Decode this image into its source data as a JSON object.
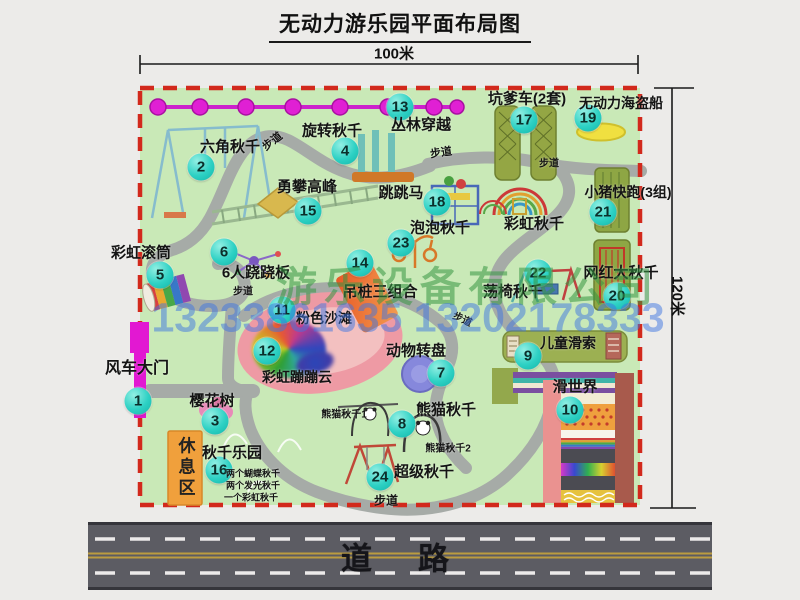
{
  "title": "无动力游乐园平面布局图",
  "dimensions": {
    "width_label": "100米",
    "height_label": "120米"
  },
  "road": {
    "label": "道路"
  },
  "rest_area": {
    "label": "休息区"
  },
  "watermark": {
    "company": "游乐设备有限公司",
    "phone": "13233861635 13202178333"
  },
  "path_label_text": "步道",
  "path_label_positions": [
    {
      "x": 272,
      "y": 141,
      "rot": -38,
      "fs": 11
    },
    {
      "x": 441,
      "y": 152,
      "rot": -8,
      "fs": 11
    },
    {
      "x": 549,
      "y": 162,
      "rot": 0,
      "fs": 10
    },
    {
      "x": 243,
      "y": 290,
      "rot": 0,
      "fs": 10
    },
    {
      "x": 463,
      "y": 318,
      "rot": 25,
      "fs": 10
    },
    {
      "x": 386,
      "y": 500,
      "rot": 0,
      "fs": 12
    }
  ],
  "extra_labels": [
    {
      "text": "彩虹秋千",
      "x": 534,
      "y": 223,
      "fs": 15
    }
  ],
  "attractions": [
    {
      "num": "1",
      "label": "风车大门",
      "cx": 138,
      "cy": 401,
      "lx": 137,
      "ly": 366,
      "fs": 16
    },
    {
      "num": "2",
      "label": "六角秋千",
      "cx": 201,
      "cy": 167,
      "lx": 230,
      "ly": 146,
      "fs": 15
    },
    {
      "num": "3",
      "label": "樱花树",
      "cx": 215,
      "cy": 421,
      "lx": 212,
      "ly": 400,
      "fs": 15
    },
    {
      "num": "4",
      "label": "旋转秋千",
      "cx": 345,
      "cy": 151,
      "lx": 332,
      "ly": 130,
      "fs": 15
    },
    {
      "num": "5",
      "label": "彩虹滚筒",
      "cx": 160,
      "cy": 275,
      "lx": 141,
      "ly": 252,
      "fs": 15
    },
    {
      "num": "6",
      "label": "6人跷跷板",
      "cx": 224,
      "cy": 252,
      "lx": 256,
      "ly": 272,
      "fs": 15
    },
    {
      "num": "7",
      "label": "动物转盘",
      "cx": 441,
      "cy": 373,
      "lx": 416,
      "ly": 350,
      "fs": 15
    },
    {
      "num": "8",
      "label": "熊猫秋千",
      "cx": 402,
      "cy": 424,
      "lx": 446,
      "ly": 409,
      "fs": 15,
      "sub": [
        {
          "text": "熊猫秋千1",
          "x": 344,
          "y": 413,
          "fs": 10
        },
        {
          "text": "熊猫秋千2",
          "x": 448,
          "y": 447,
          "fs": 10
        }
      ]
    },
    {
      "num": "9",
      "label": "儿童滑索",
      "cx": 528,
      "cy": 356,
      "lx": 568,
      "ly": 343,
      "fs": 14
    },
    {
      "num": "10",
      "label": "滑世界",
      "cx": 570,
      "cy": 410,
      "lx": 575,
      "ly": 386,
      "fs": 15
    },
    {
      "num": "11",
      "label": "粉色沙滩",
      "cx": 282,
      "cy": 310,
      "lx": 324,
      "ly": 318,
      "fs": 14
    },
    {
      "num": "12",
      "label": "彩虹蹦蹦云",
      "cx": 267,
      "cy": 351,
      "lx": 297,
      "ly": 377,
      "fs": 14
    },
    {
      "num": "13",
      "label": "丛林穿越",
      "cx": 400,
      "cy": 107,
      "lx": 421,
      "ly": 124,
      "fs": 15
    },
    {
      "num": "14",
      "label": "吊桩三组合",
      "cx": 360,
      "cy": 263,
      "lx": 380,
      "ly": 291,
      "fs": 15
    },
    {
      "num": "15",
      "label": "勇攀高峰",
      "cx": 308,
      "cy": 211,
      "lx": 307,
      "ly": 186,
      "fs": 15
    },
    {
      "num": "16",
      "label": "秋千乐园",
      "cx": 219,
      "cy": 470,
      "lx": 232,
      "ly": 452,
      "fs": 15,
      "sub": [
        {
          "text": "两个蝴蝶秋千",
          "x": 253,
          "y": 473,
          "fs": 9
        },
        {
          "text": "两个发光秋千",
          "x": 253,
          "y": 485,
          "fs": 9
        },
        {
          "text": "一个彩虹秋千",
          "x": 251,
          "y": 497,
          "fs": 9
        }
      ]
    },
    {
      "num": "17",
      "label": "坑爹车(2套)",
      "cx": 524,
      "cy": 120,
      "lx": 527,
      "ly": 98,
      "fs": 15
    },
    {
      "num": "18",
      "label": "跳跳马",
      "cx": 437,
      "cy": 202,
      "lx": 401,
      "ly": 192,
      "fs": 15
    },
    {
      "num": "19",
      "label": "无动力海盗船",
      "cx": 588,
      "cy": 118,
      "lx": 621,
      "ly": 103,
      "fs": 14
    },
    {
      "num": "20",
      "label": "网红大秋千",
      "cx": 617,
      "cy": 296,
      "lx": 621,
      "ly": 272,
      "fs": 15
    },
    {
      "num": "21",
      "label": "小猪快跑(3组)",
      "cx": 603,
      "cy": 212,
      "lx": 628,
      "ly": 192,
      "fs": 14
    },
    {
      "num": "22",
      "label": "荡椅秋千",
      "cx": 538,
      "cy": 273,
      "lx": 513,
      "ly": 291,
      "fs": 15
    },
    {
      "num": "23",
      "label": "泡泡秋千",
      "cx": 401,
      "cy": 243,
      "lx": 440,
      "ly": 227,
      "fs": 15
    },
    {
      "num": "24",
      "label": "超级秋千",
      "cx": 380,
      "cy": 477,
      "lx": 424,
      "ly": 471,
      "fs": 15
    }
  ],
  "colors": {
    "park_green": "#c9e9b7",
    "border_red": "#d2291c",
    "badge_teal": "#2ed1c4",
    "gate_magenta": "#e218d2",
    "chain_magenta": "#e020d4",
    "rest_orange": "#f0a03c",
    "road_gray": "#5c5c63",
    "path_gray": "#a6aba7"
  }
}
